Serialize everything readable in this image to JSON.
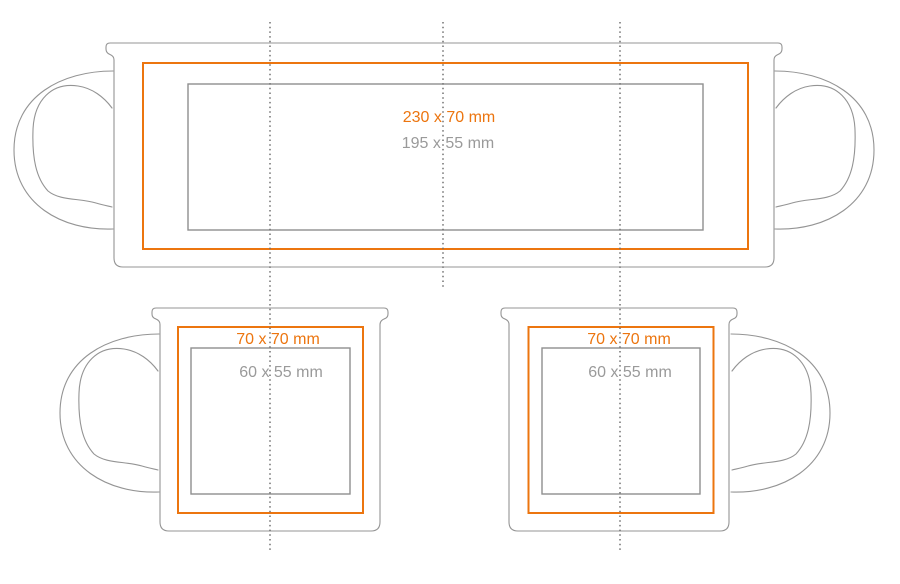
{
  "colors": {
    "print_area_orange": "#EC750F",
    "safe_area_gray": "#8F8F8F",
    "mug_outline_gray": "#949494",
    "label_gray": "#9A9A9A",
    "guide_line_gray": "#707070",
    "page_background": "#FFFFFF"
  },
  "large_mug": {
    "print_area_label": "230 x 70 mm",
    "safe_area_label": "195 x 55 mm"
  },
  "small_mug_left": {
    "print_area_label": "70 x 70 mm",
    "safe_area_label": "60 x 55 mm"
  },
  "small_mug_right": {
    "print_area_label": "70 x 70 mm",
    "safe_area_label": "60 x 55 mm"
  }
}
